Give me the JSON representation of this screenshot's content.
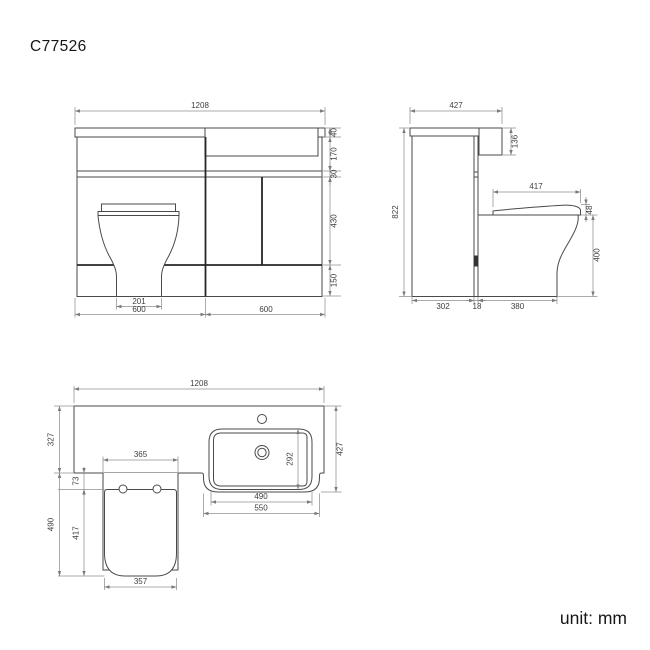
{
  "title": "C77526",
  "unit_label": "unit: mm",
  "colors": {
    "background": "#ffffff",
    "line": "#4a4a4a",
    "line_strong": "#262626",
    "dimension_line": "#8f8f8f",
    "text": "#3d3d3d"
  },
  "views": {
    "front": {
      "total_width": "1208",
      "countertop_thickness": "40",
      "basin_recess_height": "170",
      "worktop_gap": "30",
      "door_height": "430",
      "plinth_height": "150",
      "pan_base_width": "201",
      "left_section_width": "600",
      "right_section_width": "600"
    },
    "side": {
      "total_depth": "427",
      "upstand_height": "136",
      "total_height": "822",
      "seat_depth": "417",
      "seat_thickness": "48",
      "pan_height": "400",
      "cabinet_depth": "302",
      "panel_thickness": "18",
      "pan_depth": "380"
    },
    "plan": {
      "total_width": "1208",
      "counter_depth": "327",
      "total_depth": "427",
      "basin_depth": "292",
      "basin_width": "490",
      "sink_unit_width": "550",
      "cistern_width": "365",
      "seat_gap": "73",
      "seat_length": "417",
      "pan_length": "490",
      "seat_width": "357"
    }
  }
}
